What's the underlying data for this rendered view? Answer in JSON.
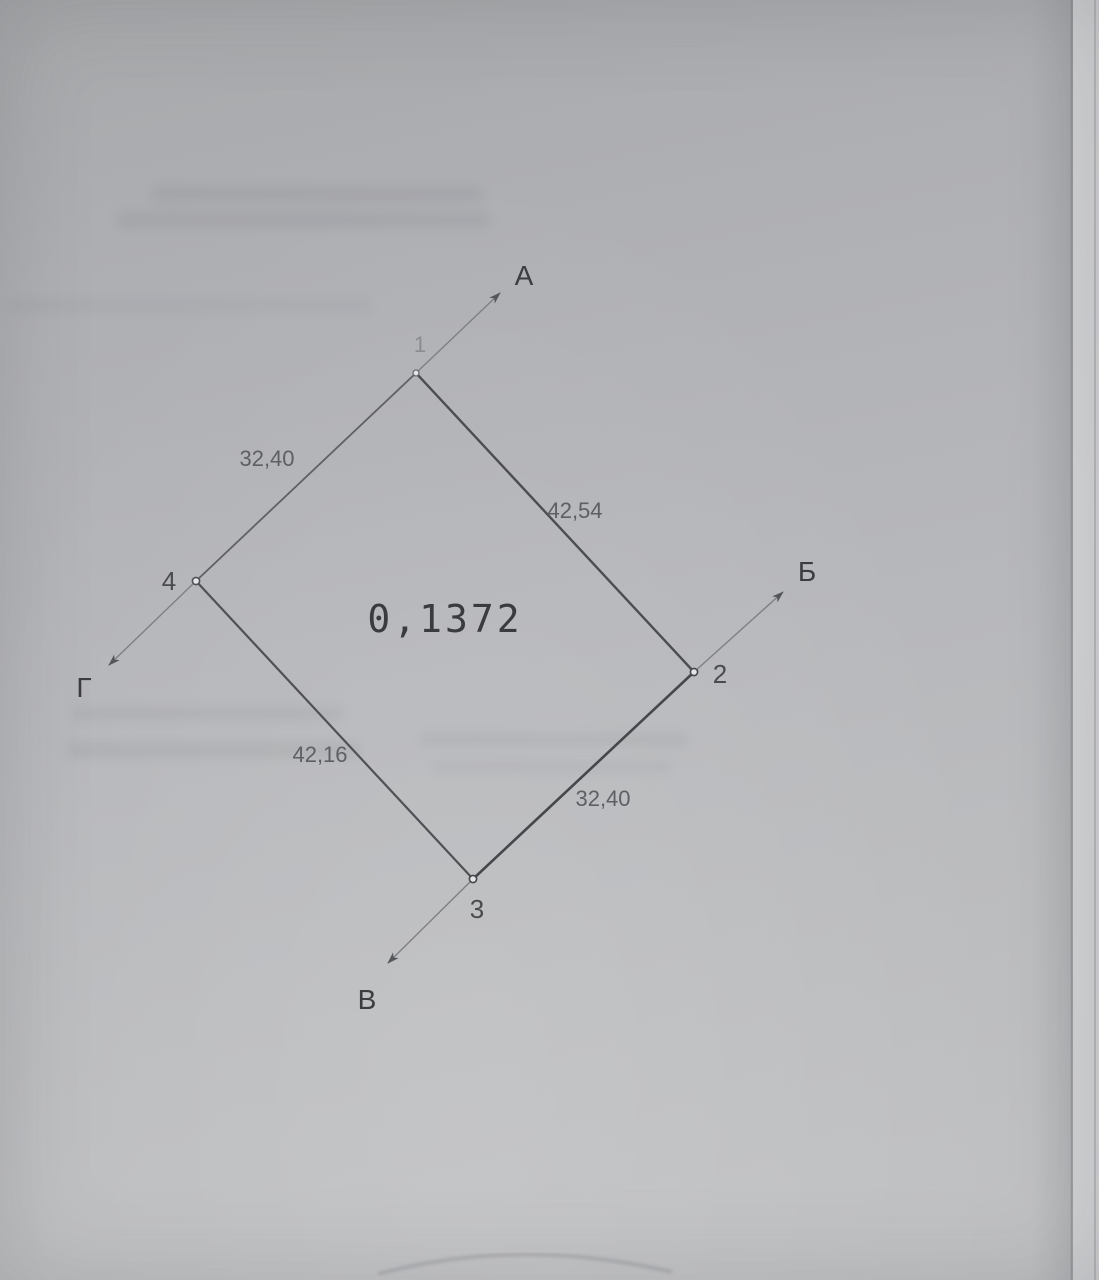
{
  "diagram": {
    "area_value": "0,1372",
    "vertices": {
      "v1": {
        "number": "1",
        "direction": "А"
      },
      "v2": {
        "number": "2",
        "direction": "Б"
      },
      "v3": {
        "number": "3",
        "direction": "В"
      },
      "v4": {
        "number": "4",
        "direction": "Г"
      }
    },
    "sides": {
      "s4_1": "32,40",
      "s1_2": "42,54",
      "s4_3": "42,16",
      "s3_2": "32,40"
    }
  }
}
